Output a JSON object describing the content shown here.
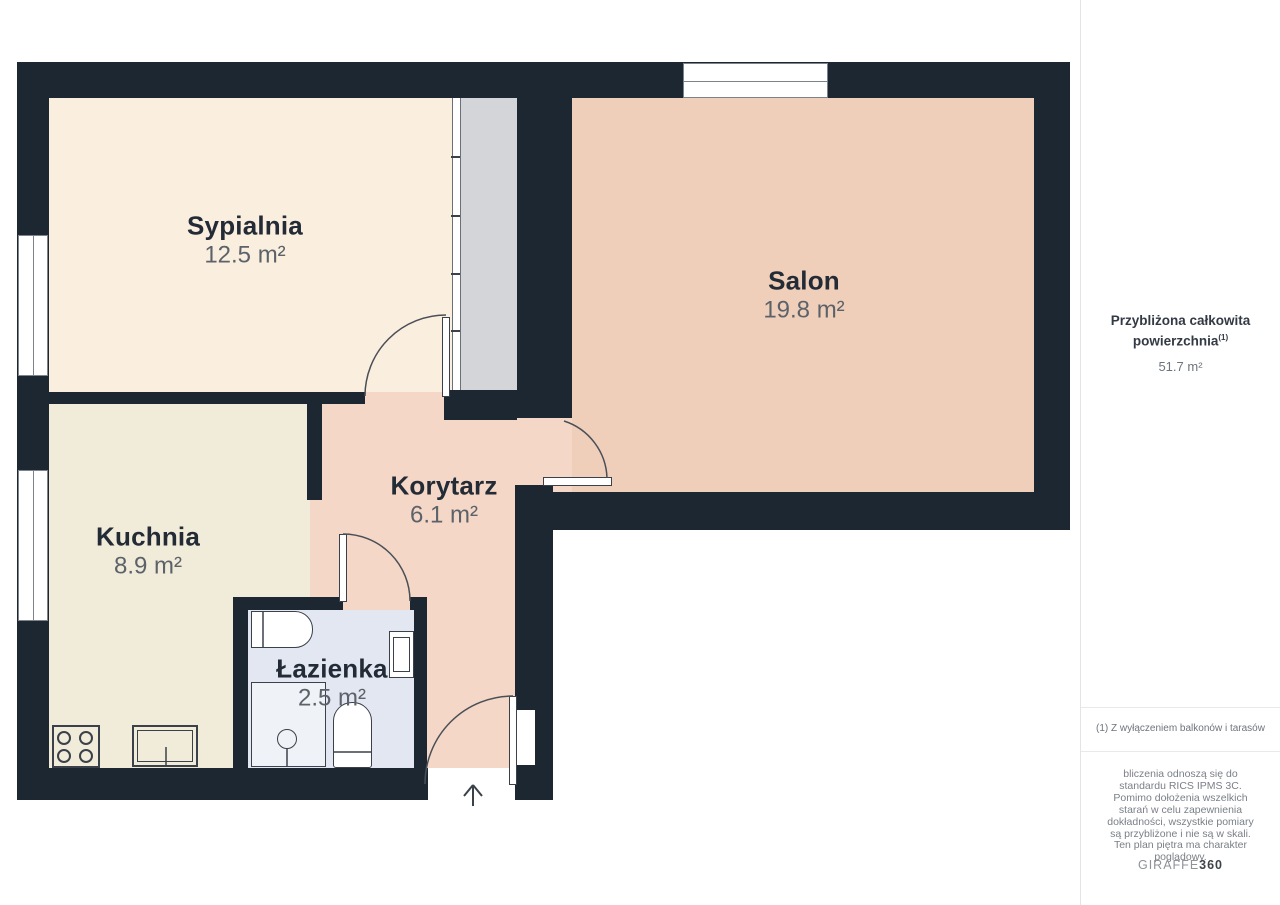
{
  "floorplan": {
    "rooms": [
      {
        "name": "Sypialnia",
        "area": "12.5 m²"
      },
      {
        "name": "Salon",
        "area": "19.8 m²"
      },
      {
        "name": "Kuchnia",
        "area": "8.9 m²"
      },
      {
        "name": "Korytarz",
        "area": "6.1 m²"
      },
      {
        "name": "Łazienka",
        "area": "2.5 m²"
      }
    ],
    "colors": {
      "wall": "#1C2731",
      "bedroom_floor": "#FAEEDE",
      "kitchen_floor": "#F1EBD9",
      "salon_floor": "#EFCEBA",
      "hall_floor": "#F4D7C6",
      "bathroom_floor": "#E2E7F1",
      "wardrobe": "#D4D5D8"
    }
  },
  "sidebar": {
    "total_label_line1": "Przybliżona całkowita",
    "total_label_line2": "powierzchnia",
    "total_superscript": "(1)",
    "total_value": "51.7 m²",
    "footnote": "(1) Z wyłączeniem balkonów i tarasów",
    "disclaimer": "bliczenia odnoszą się do standardu RICS IPMS 3C. Pomimo dołożenia wszelkich starań w celu zapewnienia dokładności, wszystkie pomiary są przybliżone i nie są w skali. Ten plan piętra ma charakter poglądowy.",
    "logo_primary": "GIRAFFE",
    "logo_secondary": "360"
  }
}
